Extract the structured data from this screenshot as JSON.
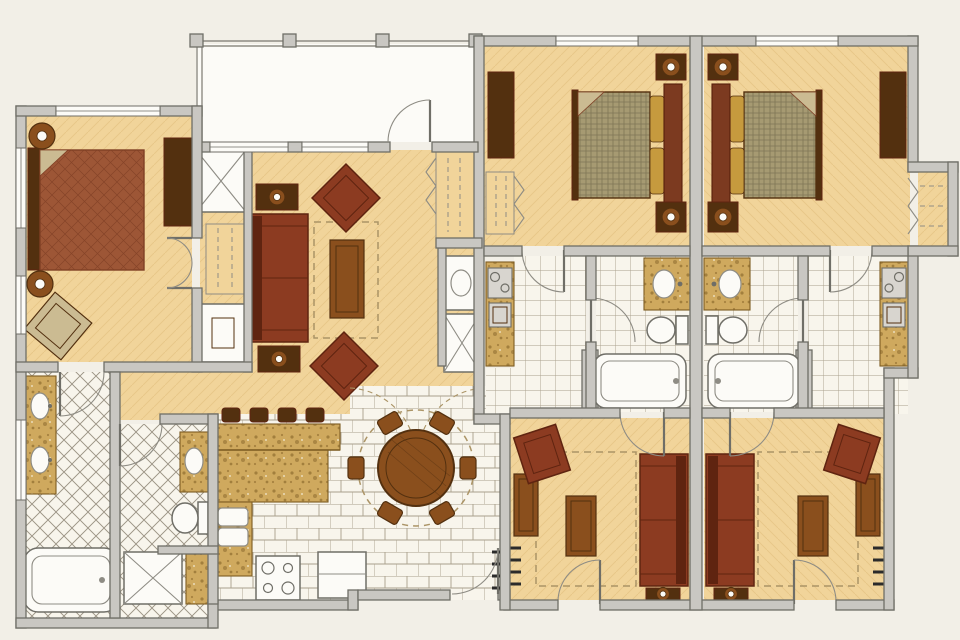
{
  "meta": {
    "type": "floor-plan",
    "style": "hand-rendered color architectural floor plan, no text labels visible"
  },
  "colors": {
    "pageBg": "#f2efe7",
    "floor": "#f1d49a",
    "floorHatch": "#e0bf7d",
    "tile": "#f8f5ec",
    "tileLine": "#a9a08c",
    "tileDiaLine": "#9b9384",
    "wallFill": "#c9c7c2",
    "wallLine": "#6f6e67",
    "thin": "#8e8c84",
    "woodDark": "#53300f",
    "woodMid": "#8a4f1d",
    "woodLight": "#b87933",
    "sofa": "#8c3b21",
    "sofaDark": "#5f2410",
    "bedRed": "#9d5636",
    "bedLine": "#7f3f24",
    "bedFrame": "#7c3a20",
    "bedFrameD": "#571f0c",
    "olive": "#a69a72",
    "oliveLine": "#746b4e",
    "granite": "#cfa95e",
    "graniteDot": "#7d5c22",
    "gold": "#c69a3e",
    "beige": "#cbbb92",
    "white": "#fcfbf7",
    "rug": "#ab9466",
    "black": "#2b2b2b",
    "applGray": "#d8d5cf"
  },
  "plan": {
    "units": [
      {
        "name": "two-bedroom-suite",
        "rooms": [
          {
            "name": "balcony",
            "fixtures": [
              "railing",
              "railing-posts"
            ]
          },
          {
            "name": "master-bedroom",
            "fixtures": [
              "king-bed",
              "nightstand-with-lamp",
              "nightstand-with-lamp",
              "armoire",
              "accent-chair",
              "tv-cabinet",
              "linen-closet",
              "wardrobe-closet"
            ]
          },
          {
            "name": "living-room",
            "fixtures": [
              "sofa",
              "armchair",
              "armchair",
              "coffee-table",
              "end-table-with-lamp",
              "end-table-with-lamp",
              "area-rug",
              "coat-closet",
              "laundry-sink",
              "utility-closet"
            ]
          },
          {
            "name": "dining-area",
            "fixtures": [
              "round-dining-table",
              "dining-chairs",
              "area-rug"
            ]
          },
          {
            "name": "kitchen",
            "fixtures": [
              "l-shaped-granite-counter",
              "bar-stools",
              "double-sink",
              "range-four-burner",
              "refrigerator"
            ]
          },
          {
            "name": "master-bathroom",
            "fixtures": [
              "double-vanity",
              "bathtub"
            ]
          },
          {
            "name": "guest-bathroom",
            "fixtures": [
              "vanity-sink",
              "toilet",
              "shower",
              "granite-counter"
            ]
          },
          {
            "name": "entry-foyer",
            "fixtures": [
              "entry-door"
            ]
          }
        ]
      },
      {
        "name": "studio-suite-left",
        "rooms": [
          {
            "name": "bedroom",
            "fixtures": [
              "queen-bed",
              "nightstand-with-lamp",
              "nightstand-with-lamp",
              "dresser",
              "wardrobe-closet"
            ]
          },
          {
            "name": "bathroom",
            "fixtures": [
              "vanity-sink",
              "toilet",
              "bathtub"
            ]
          },
          {
            "name": "kitchenette",
            "fixtures": [
              "granite-counter",
              "two-burner-cooktop",
              "mini-fridge"
            ]
          },
          {
            "name": "living-area",
            "fixtures": [
              "sofa",
              "armchair",
              "coffee-table",
              "tv-stand",
              "end-table-with-lamp",
              "area-rug"
            ]
          }
        ]
      },
      {
        "name": "studio-suite-right",
        "rooms": [
          {
            "name": "bedroom",
            "fixtures": [
              "queen-bed",
              "nightstand-with-lamp",
              "nightstand-with-lamp",
              "dresser",
              "walk-in-closet"
            ]
          },
          {
            "name": "bathroom",
            "fixtures": [
              "vanity-sink",
              "toilet",
              "bathtub"
            ]
          },
          {
            "name": "kitchenette",
            "fixtures": [
              "granite-counter",
              "two-burner-cooktop",
              "mini-fridge"
            ]
          },
          {
            "name": "living-area",
            "fixtures": [
              "sofa",
              "armchair",
              "coffee-table",
              "tv-stand",
              "end-table-with-lamp",
              "area-rug"
            ]
          }
        ]
      }
    ],
    "counts": {
      "beds": 3,
      "sofas": 3,
      "armchairs": 5,
      "dining_chairs": 6,
      "bar_stools": 4,
      "bathtubs": 3,
      "toilets": 3,
      "sink_basins": 9
    }
  }
}
